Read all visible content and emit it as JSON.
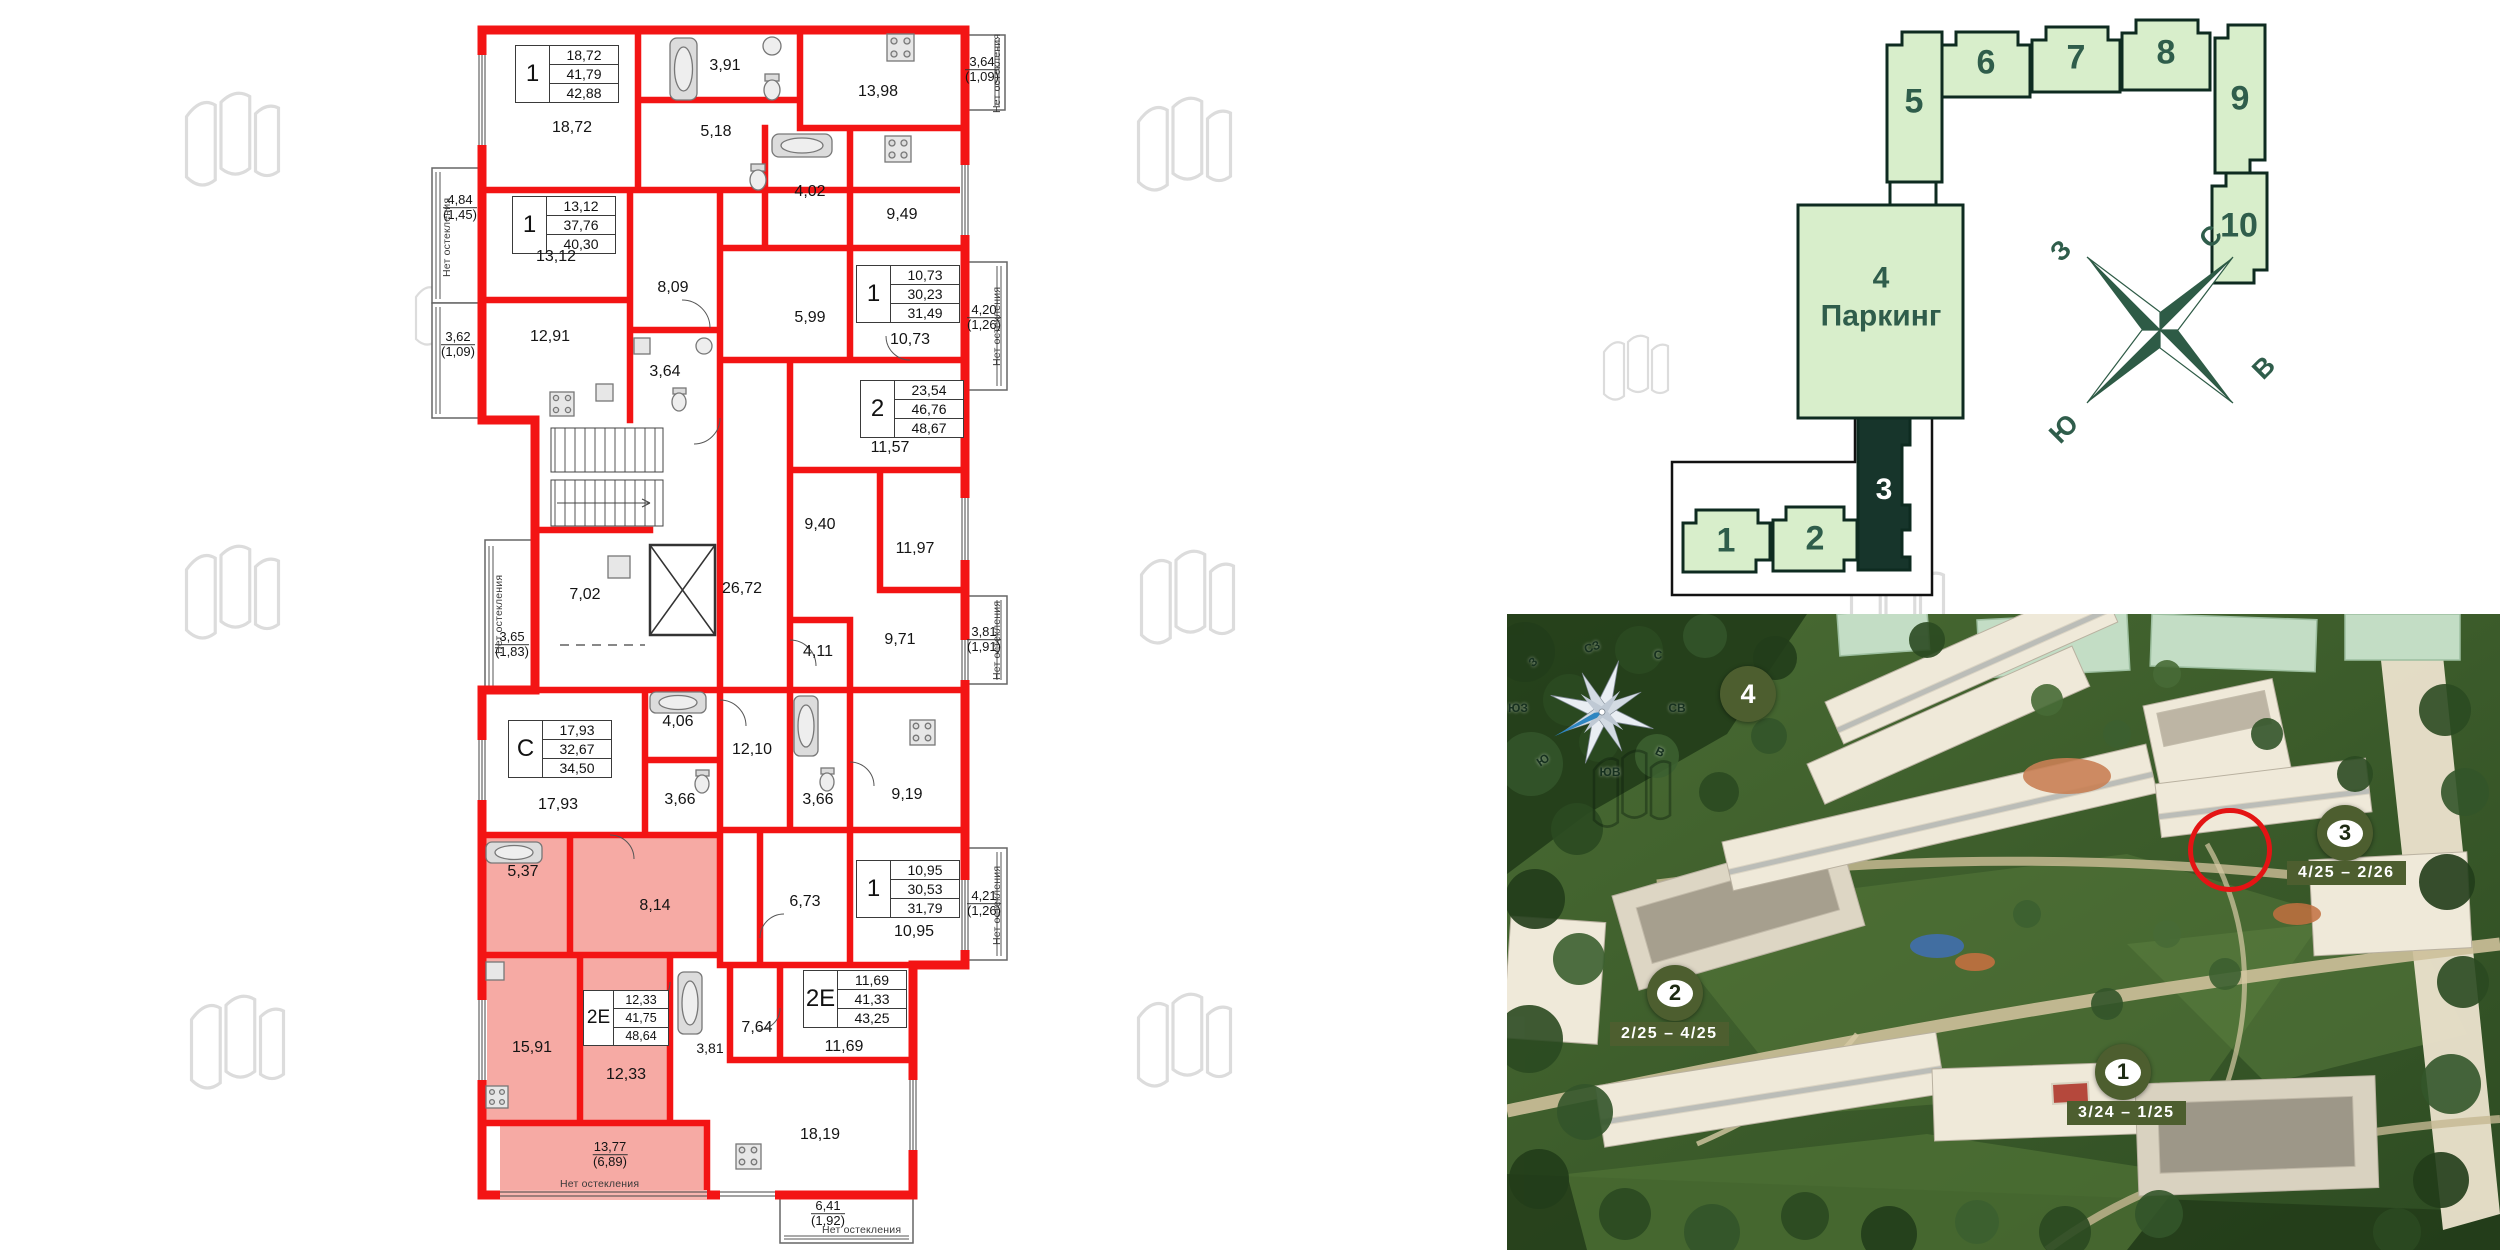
{
  "floor_plan": {
    "no_glazing": "Нет остекления",
    "tables": [
      {
        "type": "1",
        "v1": "18,72",
        "v2": "41,79",
        "v3": "42,88"
      },
      {
        "type": "1",
        "v1": "13,12",
        "v2": "37,76",
        "v3": "40,30"
      },
      {
        "type": "1",
        "v1": "10,73",
        "v2": "30,23",
        "v3": "31,49"
      },
      {
        "type": "2",
        "v1": "23,54",
        "v2": "46,76",
        "v3": "48,67"
      },
      {
        "type": "С",
        "v1": "17,93",
        "v2": "32,67",
        "v3": "34,50"
      },
      {
        "type": "1",
        "v1": "10,95",
        "v2": "30,53",
        "v3": "31,79"
      },
      {
        "type": "2Е",
        "v1": "12,33",
        "v2": "41,75",
        "v3": "48,64"
      },
      {
        "type": "2Е",
        "v1": "11,69",
        "v2": "41,33",
        "v3": "43,25"
      }
    ],
    "rooms": [
      "18,72",
      "3,91",
      "5,18",
      "13,98",
      "4,02",
      "9,49",
      "13,12",
      "8,09",
      "5,99",
      "10,73",
      "12,91",
      "3,64",
      "11,57",
      "9,40",
      "11,97",
      "7,02",
      "26,72",
      "4,11",
      "9,71",
      "4,06",
      "12,10",
      "3,66",
      "3,66",
      "9,19",
      "17,93",
      "6,73",
      "10,95",
      "5,37",
      "8,14",
      "15,91",
      "12,33",
      "3,81",
      "7,64",
      "11,69",
      "18,19"
    ],
    "balconies": [
      {
        "a": "4,84",
        "b": "(1,45)"
      },
      {
        "a": "3,62",
        "b": "(1,09)"
      },
      {
        "a": "3,64",
        "b": "(1,09)"
      },
      {
        "a": "4,20",
        "b": "(1,26)"
      },
      {
        "a": "3,65",
        "b": "(1,83)"
      },
      {
        "a": "3,81",
        "b": "(1,91)"
      },
      {
        "a": "4,21",
        "b": "(1,26)"
      },
      {
        "a": "13,77",
        "b": "(6,89)"
      },
      {
        "a": "6,41",
        "b": "(1,92)"
      }
    ]
  },
  "site_plan": {
    "buildings": [
      {
        "id": "1"
      },
      {
        "id": "2"
      },
      {
        "id": "3"
      },
      {
        "id": "4"
      },
      {
        "id": "5"
      },
      {
        "id": "6"
      },
      {
        "id": "7"
      },
      {
        "id": "8"
      },
      {
        "id": "9"
      },
      {
        "id": "10"
      }
    ],
    "parking": {
      "num": "4",
      "label": "Паркинг"
    },
    "selected_building": "3",
    "compass": {
      "n": "С",
      "s": "Ю",
      "w": "З",
      "e": "В"
    }
  },
  "aerial": {
    "compass": {
      "n": "С",
      "ne": "СВ",
      "e": "В",
      "se": "ЮВ",
      "s": "Ю",
      "sw": "ЮЗ",
      "w": "З",
      "nw": "СЗ"
    },
    "markers": [
      {
        "num": "1",
        "dates": "3/24 – 1/25"
      },
      {
        "num": "2",
        "dates": "2/25 – 4/25"
      },
      {
        "num": "3",
        "dates": "4/25 – 2/26"
      },
      {
        "num": "4",
        "dates": ""
      }
    ]
  },
  "colors": {
    "wall_red": "#f31414",
    "highlight_pink": "#f59b94",
    "site_green": "#d8eecb",
    "site_dark": "#17352b",
    "badge_green": "#4d5e2f",
    "ring_red": "#e41414"
  }
}
